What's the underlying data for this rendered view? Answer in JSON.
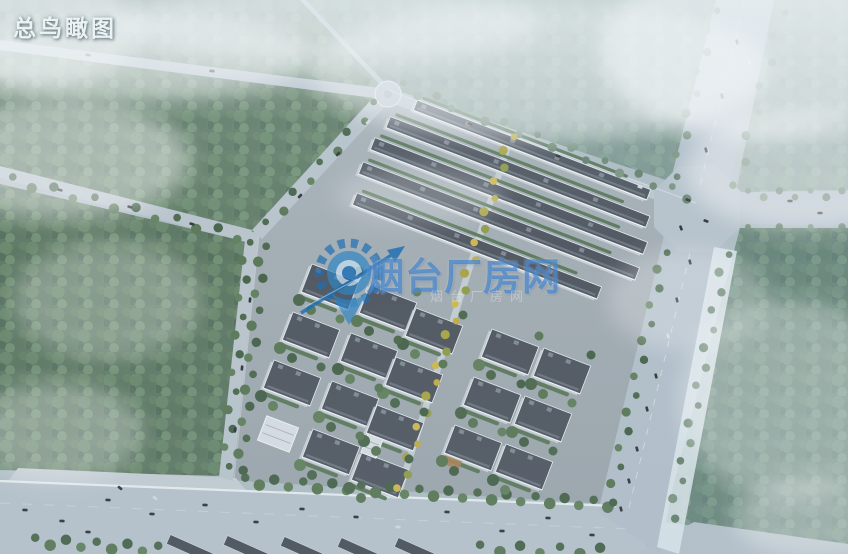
{
  "page": {
    "view_label": "总鸟瞰图"
  },
  "watermark": {
    "text": "烟台厂房网",
    "subtext": "烟台厂房网",
    "text_color": "#2b74c6",
    "logo": "gear-compass-pin-logo"
  },
  "scene_colors": {
    "haze": "#b9c7d0",
    "forest_green": "#4c684e",
    "forest_hazy_overlay": "#9cb7c7",
    "road_gray": "#b6c2cb",
    "sidewalk_white": "#dde7ed",
    "roof_dark": "#4d545e",
    "roof_unit_gray": "#7e8792",
    "wall_white": "#cdd4d9",
    "tree_green": "#4a664a",
    "tree_yellow": "#c0ac44",
    "car_dark": "#2b3137"
  }
}
